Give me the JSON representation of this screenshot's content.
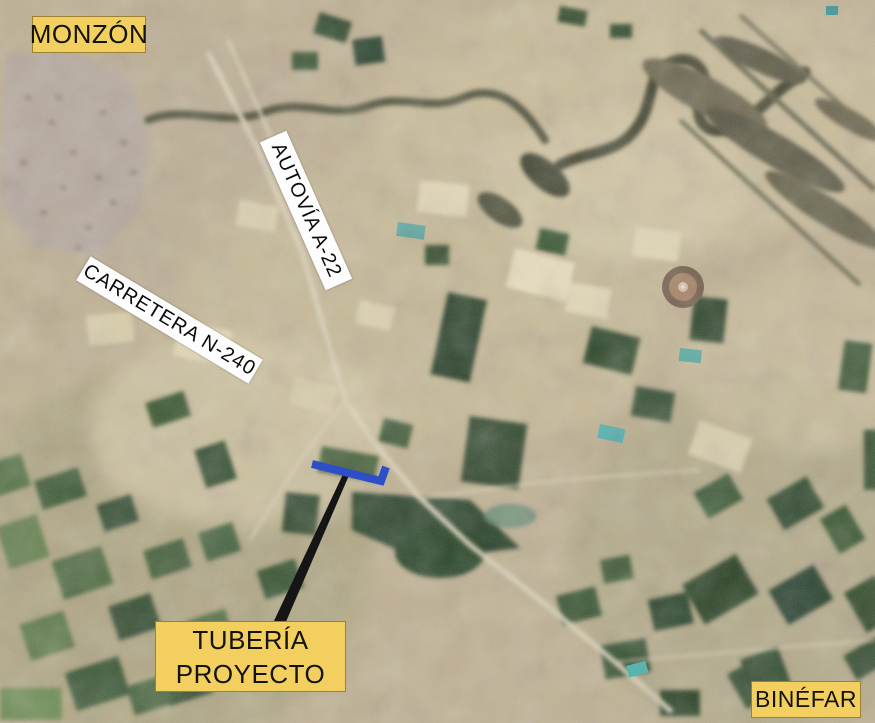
{
  "map": {
    "labels": {
      "monzon": "MONZÓN",
      "binefar": "BINÉFAR",
      "autovia_a22": "AUTOVÍA A-22",
      "carretera_n240": "CARRETERA N-240",
      "tuberia_line1": "TUBERÍA",
      "tuberia_line2": "PROYECTO"
    }
  },
  "colors": {
    "label-yellow": "#F2CF5F",
    "label-white": "#FDFDFD",
    "label-text": "#141309",
    "pipeline-blue": "#2E4EC8",
    "leader-black": "#151515",
    "terrain-tan": "#C2B291"
  }
}
